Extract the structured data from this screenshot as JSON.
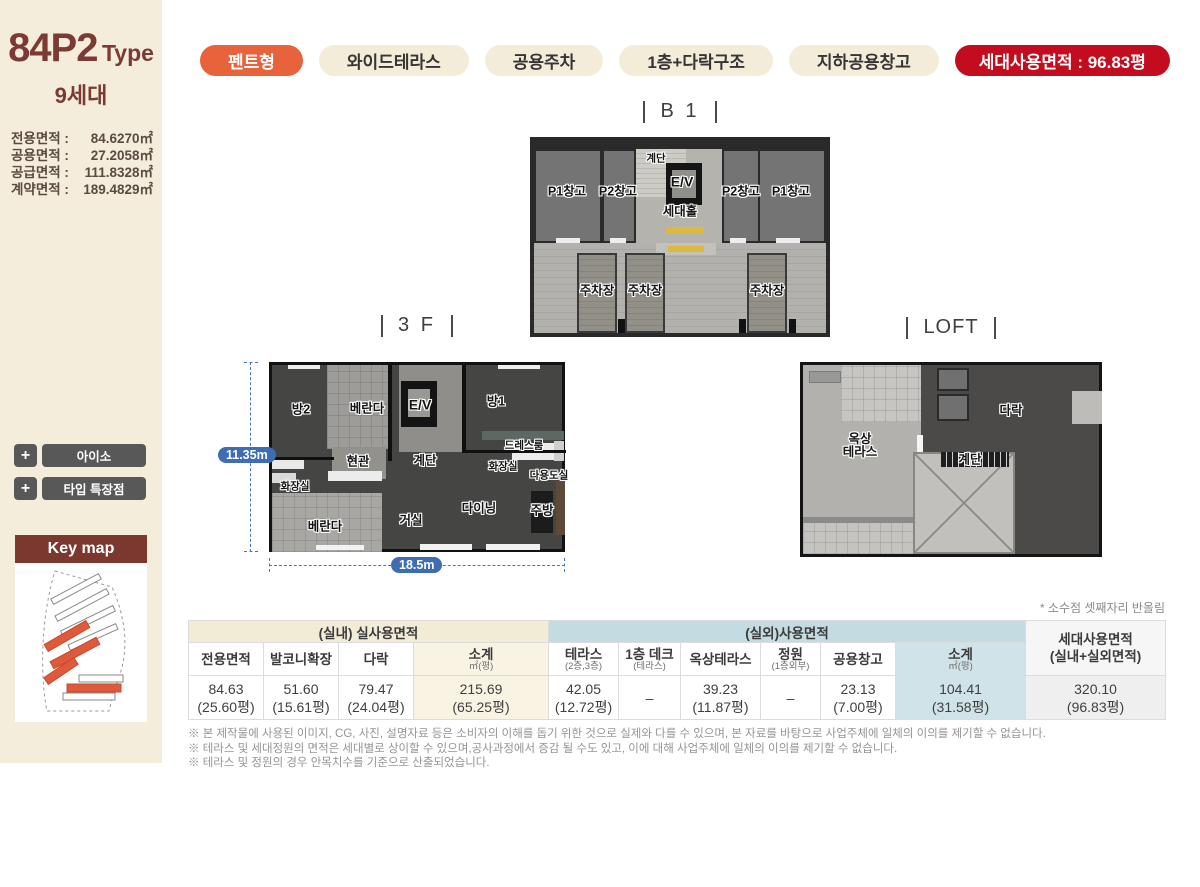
{
  "sidebar": {
    "type_code": "84P2",
    "type_suffix": "Type",
    "units": "9세대",
    "areas": [
      {
        "label": "전용면적 :",
        "value": "84.6270㎡"
      },
      {
        "label": "공용면적 :",
        "value": "27.2058㎡"
      },
      {
        "label": "공급면적 :",
        "value": "111.8328㎡"
      },
      {
        "label": "계약면적 :",
        "value": "189.4829㎡"
      }
    ],
    "buttons": [
      {
        "plus": "+",
        "label": "아이소"
      },
      {
        "plus": "+",
        "label": "타입 특장점"
      }
    ],
    "keymap_title": "Key map"
  },
  "tags": [
    {
      "label": "펜트형",
      "style": "accent"
    },
    {
      "label": "와이드테라스",
      "style": "plain"
    },
    {
      "label": "공용주차",
      "style": "plain"
    },
    {
      "label": "1층+다락구조",
      "style": "plain"
    },
    {
      "label": "지하공용창고",
      "style": "plain"
    },
    {
      "label": "세대사용면적 : 96.83평",
      "style": "red"
    }
  ],
  "colors": {
    "accent": "#e8623c",
    "badge_red": "#c30d1e",
    "maroon": "#7b3a33",
    "dim_blue": "#3e6db4"
  },
  "floors": {
    "b1": {
      "title": "B 1",
      "rooms": [
        "P1창고",
        "P2창고",
        "계단",
        "E/V",
        "세대홀",
        "P2창고",
        "P1창고",
        "주차장",
        "주차장",
        "주차장"
      ]
    },
    "f3": {
      "title": "3 F",
      "dim_height": "11.35m",
      "dim_width": "18.5m",
      "rooms": [
        "방2",
        "베란다",
        "E/V",
        "방1",
        "현관",
        "계단",
        "드레스룸",
        "화장실",
        "다용도실",
        "화장실",
        "베란다",
        "거실",
        "다이닝",
        "주방"
      ]
    },
    "loft": {
      "title": "LOFT",
      "rooms": [
        "옥상\n테라스",
        "다락",
        "계단"
      ]
    }
  },
  "table": {
    "note": "* 소수점 셋째자리 반올림",
    "group_indoor": "(실내) 실사용면적",
    "group_outdoor": "(실외)사용면적",
    "group_total": "세대사용면적\n(실내+실외면적)",
    "columns": [
      {
        "label": "전용면적",
        "sub": ""
      },
      {
        "label": "발코니확장",
        "sub": ""
      },
      {
        "label": "다락",
        "sub": ""
      },
      {
        "label": "소계",
        "sub": "㎡(평)"
      },
      {
        "label": "테라스",
        "sub": "(2층,3층)"
      },
      {
        "label": "1층 데크",
        "sub": "(테라스)"
      },
      {
        "label": "옥상테라스",
        "sub": ""
      },
      {
        "label": "정원",
        "sub": "(1층외부)"
      },
      {
        "label": "공용창고",
        "sub": ""
      },
      {
        "label": "소계",
        "sub": "㎡(평)"
      }
    ],
    "values": [
      {
        "m2": "84.63",
        "py": "(25.60평)"
      },
      {
        "m2": "51.60",
        "py": "(15.61평)"
      },
      {
        "m2": "79.47",
        "py": "(24.04평)"
      },
      {
        "m2": "215.69",
        "py": "(65.25평)"
      },
      {
        "m2": "42.05",
        "py": "(12.72평)"
      },
      {
        "m2": "–",
        "py": ""
      },
      {
        "m2": "39.23",
        "py": "(11.87평)"
      },
      {
        "m2": "–",
        "py": ""
      },
      {
        "m2": "23.13",
        "py": "(7.00평)"
      },
      {
        "m2": "104.41",
        "py": "(31.58평)"
      },
      {
        "m2": "320.10",
        "py": "(96.83평)"
      }
    ]
  },
  "footnotes": [
    "※ 본 제작물에 사용된 이미지, CG, 사진, 설명자료 등은 소비자의 이해를 돕기 위한 것으로 실제와 다를 수 있으며, 본 자료를 바탕으로 사업주체에 일체의 이의를 제기할 수 없습니다.",
    "※ 테라스 및 세대정원의 면적은 세대별로 상이할 수 있으며,공사과정에서 증감 될 수도 있고, 이에 대해 사업주체에 일체의 이의를 제기할 수 없습니다.",
    "※ 테라스 및 정원의 경우 안목치수를 기준으로 산출되었습니다."
  ]
}
